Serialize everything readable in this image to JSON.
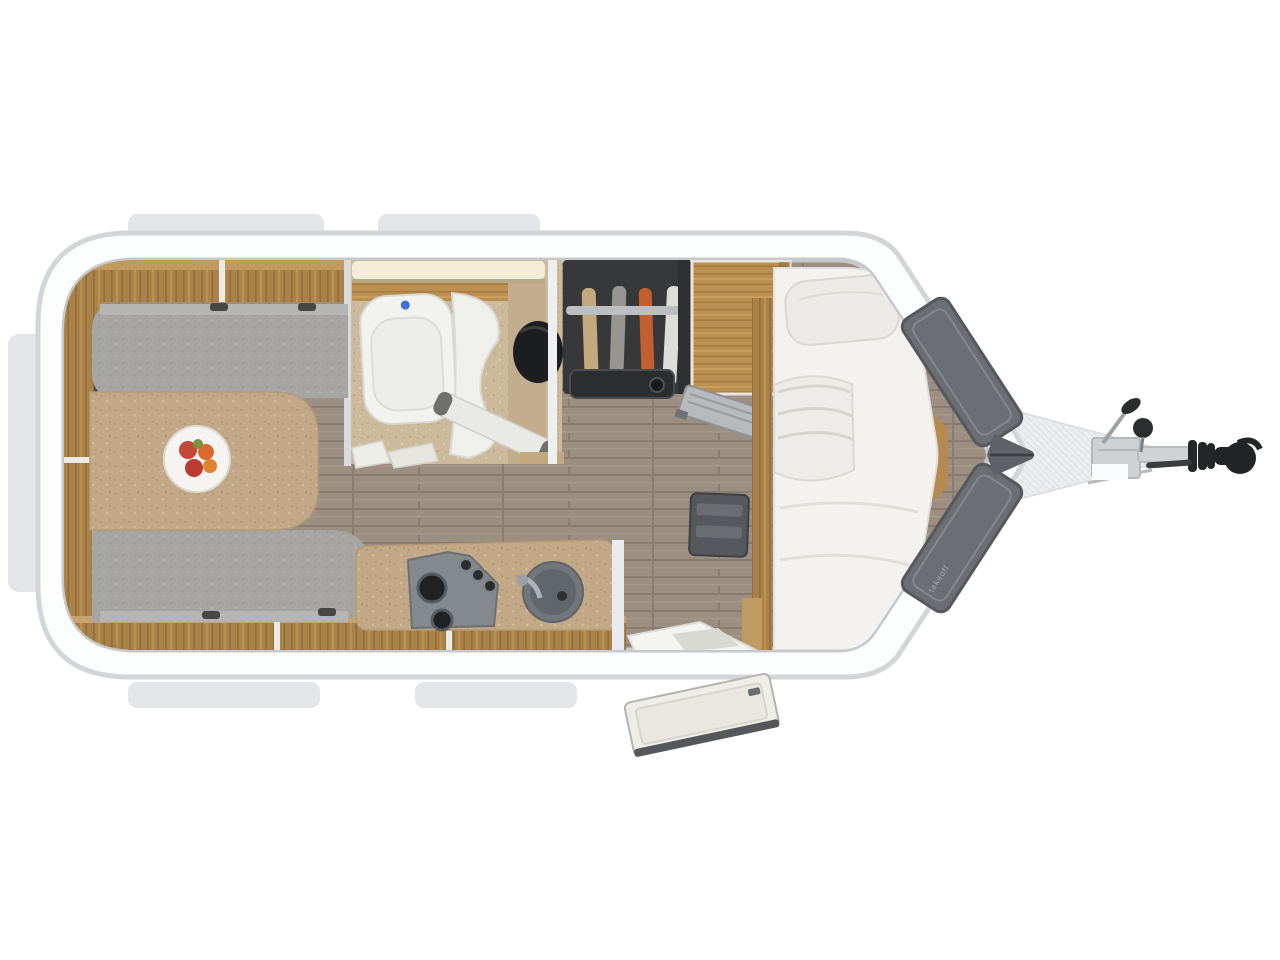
{
  "image": {
    "kind": "caravan-floorplan-top-view",
    "front_label": "takeoff",
    "regions": [
      "dinette",
      "bathroom",
      "wardrobe",
      "tall-cabinet",
      "kitchen",
      "single-bed",
      "entrance-door",
      "v-nose-storage",
      "drawbar-hitch"
    ],
    "colors": {
      "background": "#ffffff",
      "body_fill": "#fcfdfd",
      "body_stroke": "#d3d6d9",
      "tab": "#e3e5e8",
      "wall_line": "#c6c9cc",
      "floor": "#9c8e80",
      "locker_wood": "#a98149",
      "locker_wood_light": "#c19a60",
      "cabinet_wood": "#bb8f4f",
      "cushion_gray": "#a6a5a2",
      "table_counter": "#c2a887",
      "bathroom_floor": "#cdba9c",
      "toilet_white": "#f2f2ef",
      "basin_black": "#1c1d1e",
      "wardrobe_dark": "#37383a",
      "hang_rail": "#bcbfc2",
      "hanging_tan": "#c4a87e",
      "hanging_gray": "#97958f",
      "hanging_orange": "#c25f2e",
      "hanging_white": "#dddcd6",
      "mattress": "#f3f2ef",
      "pillow": "#eceae6",
      "nose_lid_gray": "#6b6f74",
      "checker_plate": "#eceef0",
      "hitch_metal": "#ced2d5",
      "hitch_black": "#242628",
      "flush_button_blue": "#3d6fd6",
      "fruit_red": "#c4473a",
      "fruit_orange": "#d96a2e"
    }
  }
}
